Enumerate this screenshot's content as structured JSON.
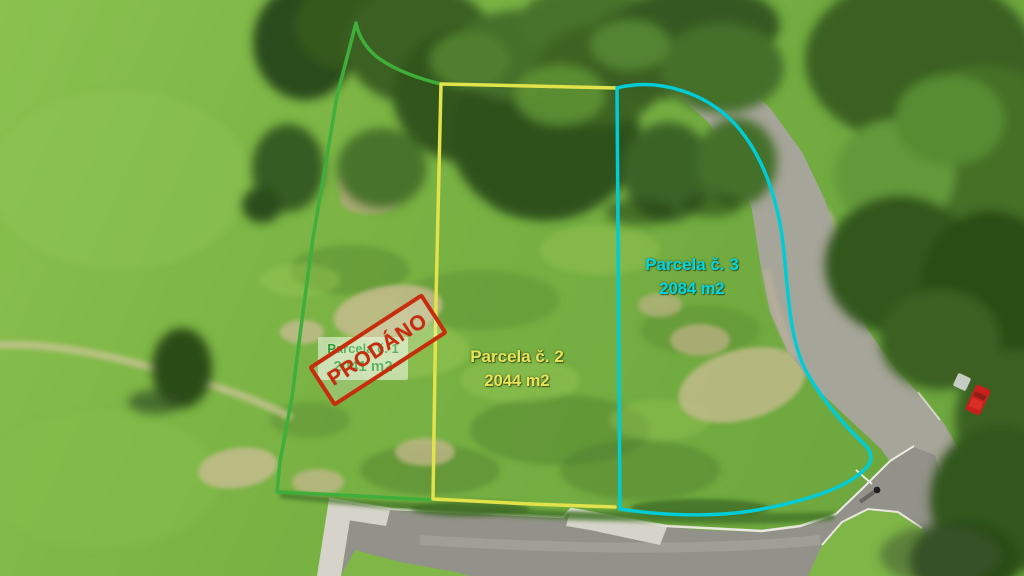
{
  "scene": {
    "kind": "aerial-drone-photo-of-building-plots"
  },
  "parcels": [
    {
      "name": "Parcela č. 1",
      "area": "2041 m2",
      "outline_color": "#3fae3a",
      "label_color": "#2f9e36"
    },
    {
      "name": "Parcela č. 2",
      "area": "2044 m2",
      "outline_color": "#e2e24a",
      "label_color": "#e8e455"
    },
    {
      "name": "Parcela č. 3",
      "area": "2084 m2",
      "outline_color": "#00ccd6",
      "label_color": "#00d8e2"
    }
  ],
  "stamp": {
    "text": "PRODÁNO",
    "color": "#c62d0d"
  }
}
